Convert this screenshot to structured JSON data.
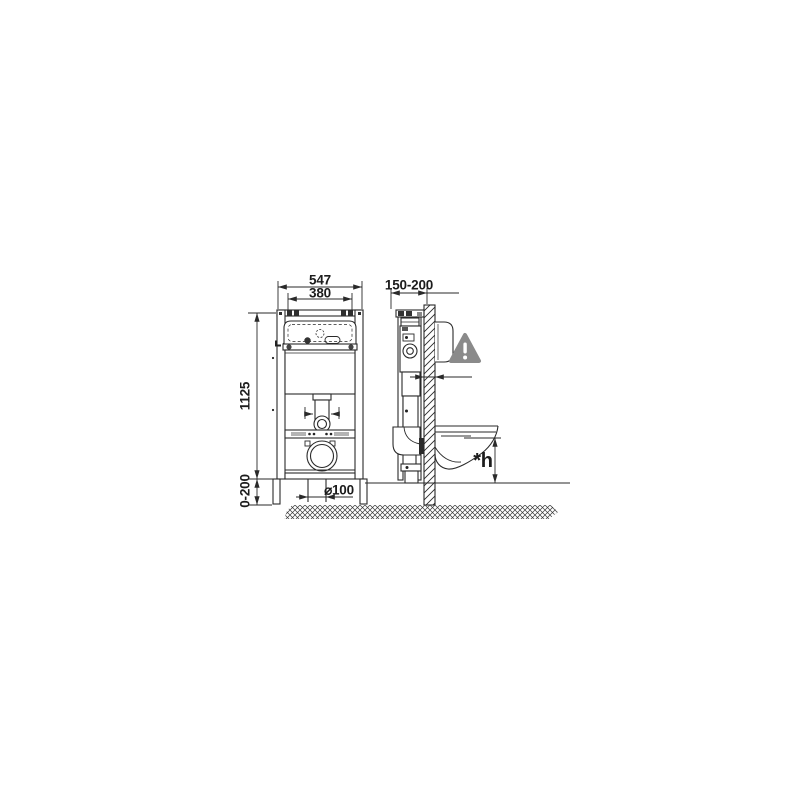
{
  "page": {
    "background_color": "#ffffff",
    "line_color": "#2a2a2a"
  },
  "diagram": {
    "type": "technical-drawing",
    "subject": "Wall-mounted WC concealed cistern installation frame, front and side views",
    "front_view": {
      "outer_width_mm": "547",
      "mounting_width_mm": "380",
      "frame_height_mm": "1125",
      "foot_adjustment_mm": "0-200",
      "drain_pipe_diameter": "⌀100"
    },
    "side_view": {
      "wall_distance_mm": "150-200",
      "bowl_height_label": "*h",
      "warning_icon": "triangle-exclamation",
      "warning_color": "#8a8a8a",
      "pad_color": "#b3b3b3"
    }
  }
}
